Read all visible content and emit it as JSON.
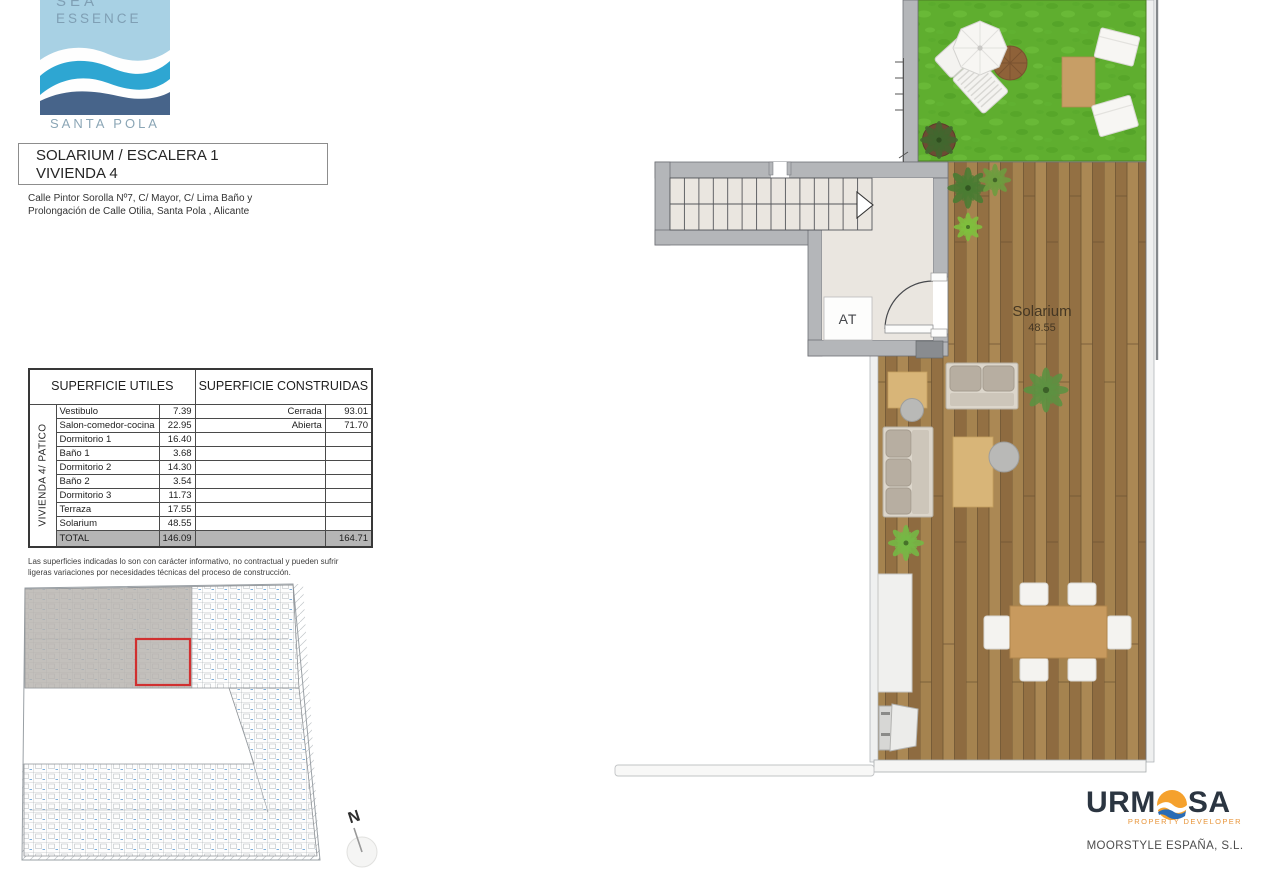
{
  "branding": {
    "logo_top_word": "SEA",
    "logo_word": "ESSENCE",
    "logo_location": "SANTA POLA"
  },
  "header": {
    "title_line1": "SOLARIUM / ESCALERA 1",
    "title_line2": "VIVIENDA 4",
    "address_line1": "Calle Pintor Sorolla Nº7, C/ Mayor, C/ Lima Baño y",
    "address_line2": "Prolongación de Calle Otilia, Santa Pola , Alicante"
  },
  "areas_table": {
    "col_utiles": "SUPERFICIE UTILES",
    "col_construidas": "SUPERFICIE CONSTRUIDAS",
    "row_group": "VIVIENDA 4/ PATICO",
    "rows": [
      {
        "name": "Vestibulo",
        "value": "7.39",
        "c_label": "Cerrada",
        "c_value": "93.01"
      },
      {
        "name": "Salon-comedor-cocina",
        "value": "22.95",
        "c_label": "Abierta",
        "c_value": "71.70"
      },
      {
        "name": "Dormitorio 1",
        "value": "16.40",
        "c_label": "",
        "c_value": ""
      },
      {
        "name": "Baño 1",
        "value": "3.68",
        "c_label": "",
        "c_value": ""
      },
      {
        "name": "Dormitorio 2",
        "value": "14.30",
        "c_label": "",
        "c_value": ""
      },
      {
        "name": "Baño 2",
        "value": "3.54",
        "c_label": "",
        "c_value": ""
      },
      {
        "name": "Dormitorio 3",
        "value": "11.73",
        "c_label": "",
        "c_value": ""
      },
      {
        "name": "Terraza",
        "value": "17.55",
        "c_label": "",
        "c_value": ""
      },
      {
        "name": "Solarium",
        "value": "48.55",
        "c_label": "",
        "c_value": ""
      }
    ],
    "total_label": "TOTAL",
    "total_utiles": "146.09",
    "total_construidas": "164.71"
  },
  "disclaimer_line1": "Las superficies indicadas lo son con carácter informativo, no contractual y pueden sufrir",
  "disclaimer_line2": "ligeras variaciones por necesidades técnicas del proceso de construcción.",
  "plan": {
    "room_label": "Solarium",
    "room_area": "48.55",
    "elevator_label": "AT",
    "north_label": "N"
  },
  "developer": {
    "name_left": "URM",
    "name_right": "SA",
    "tagline": "PROPERTY DEVELOPER",
    "company": "MOORSTYLE ESPAÑA, S.L."
  },
  "colors": {
    "logo_light_blue": "#a8d1e4",
    "logo_cyan": "#2ea6d2",
    "logo_dark_blue": "#47648a",
    "grass_green": "#5fae2f",
    "deck_wood": "#9d7b4b",
    "wall_grey": "#b4b6b9",
    "highlight_red": "#d03030",
    "urmosa_orange": "#f5a12d",
    "urmosa_navy": "#2b3541"
  }
}
